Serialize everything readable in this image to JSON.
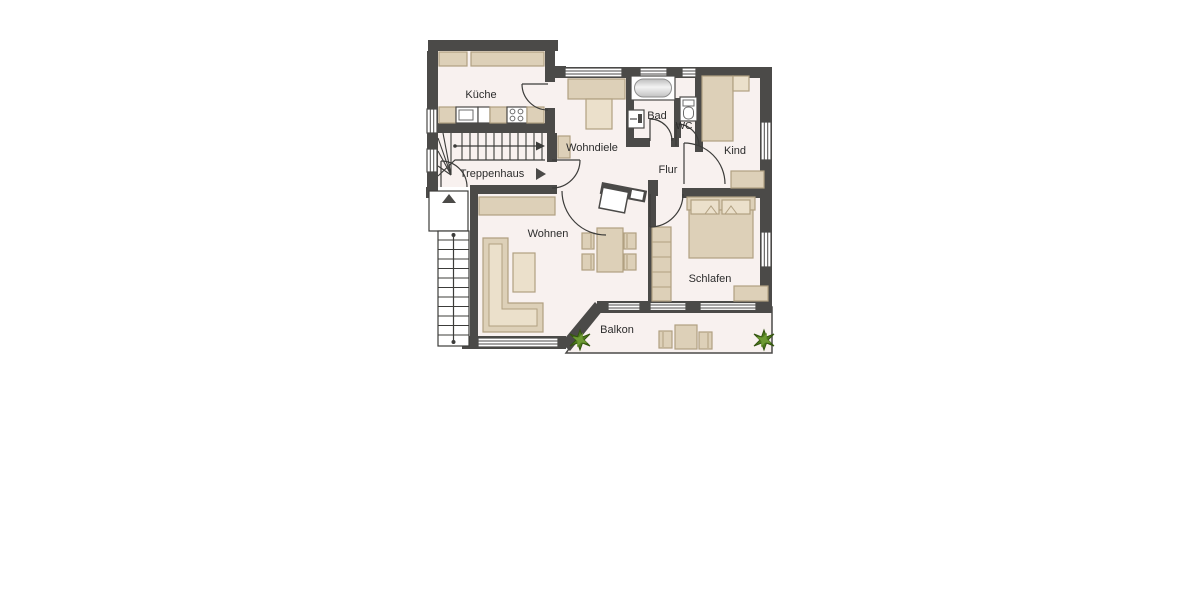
{
  "plan": {
    "type": "apartment-floor-plan",
    "rooms": {
      "kueche": {
        "label": "Küche"
      },
      "wohndiele": {
        "label": "Wohndiele"
      },
      "bad": {
        "label": "Bad"
      },
      "wc": {
        "label": "WC"
      },
      "kind": {
        "label": "Kind"
      },
      "flur": {
        "label": "Flur"
      },
      "treppenhaus": {
        "label": "Treppenhaus"
      },
      "wohnen": {
        "label": "Wohnen"
      },
      "schlafen": {
        "label": "Schlafen"
      },
      "balkon": {
        "label": "Balkon"
      }
    },
    "icons": {
      "stair_direction_icon": "▶",
      "stair_up_icon": "▲",
      "plant_icon": "✹"
    },
    "colors": {
      "wall": "#4b4a48",
      "floor": "#f8f1ef",
      "furniture": "#ddd0b8",
      "furniture_stroke": "#b1a081",
      "furniture_light": "#ebe0cb",
      "plant": "#4e7c1c",
      "background": "#ffffff",
      "label_text": "#2c2c2c"
    }
  }
}
